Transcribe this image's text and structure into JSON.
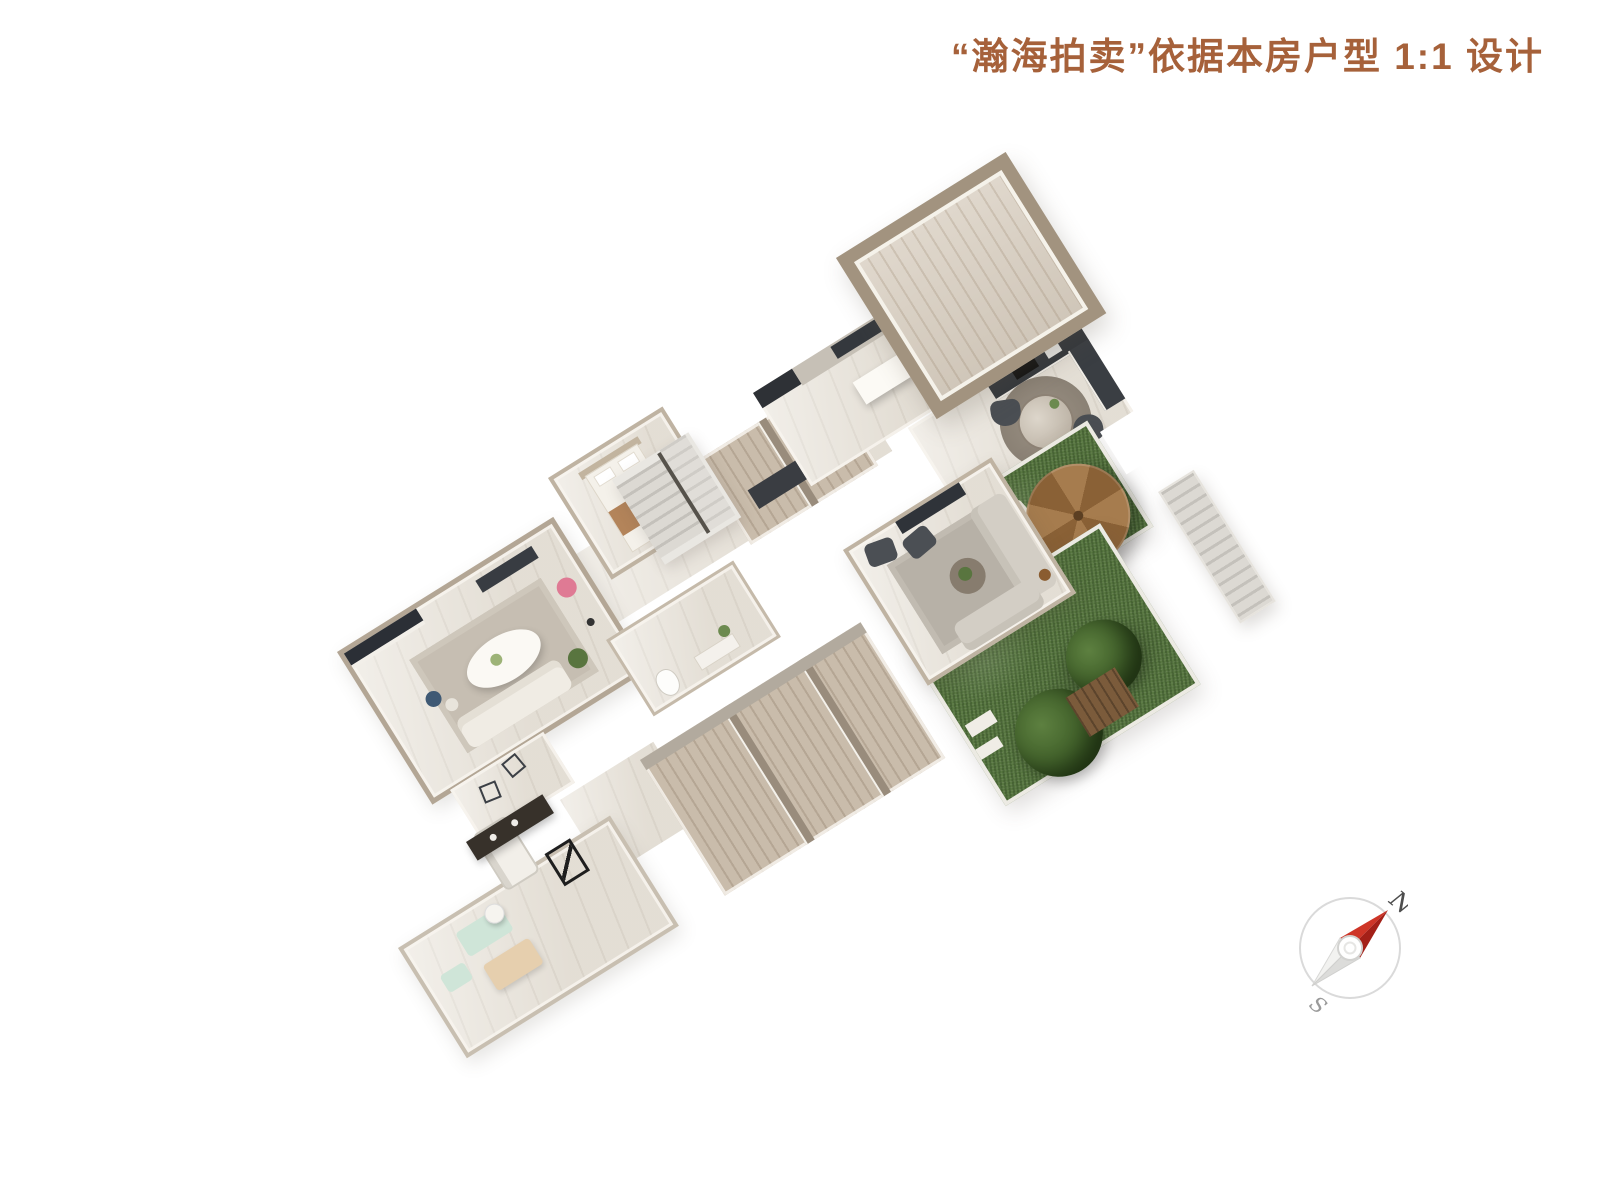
{
  "title": {
    "text": "“瀚海拍卖”依据本房户型 1:1 设计",
    "color": "#A6613A"
  },
  "watermarks": {
    "logo_icon": "laurel-wreath-gavel-icon",
    "items": [
      {
        "location": "top-room",
        "text": "瀚海"
      },
      {
        "location": "center-hall",
        "text": "瀚海拍卖",
        "registered_mark": "®"
      },
      {
        "location": "lower-garden",
        "text": "瀚海"
      },
      {
        "location": "gym-room",
        "text": "海拍卖"
      }
    ]
  },
  "compass": {
    "north_label": "N",
    "south_label": "S",
    "needle_color": "#C23A2E",
    "ring_color": "#DADADA"
  },
  "palette": {
    "background": "#FFFFFF",
    "title_accent": "#A6613A",
    "wall_taupe": "#A2937F",
    "floor_marble": "#EAE5DC",
    "floor_wood_light": "#D8CEC0",
    "floor_wood_tan": "#C9BCAB",
    "grass_green": "#587741",
    "counter_dark": "#33373C",
    "parasol_brown": "#A67C4E",
    "watermark_white": "rgba(255,255,255,0.82)"
  }
}
